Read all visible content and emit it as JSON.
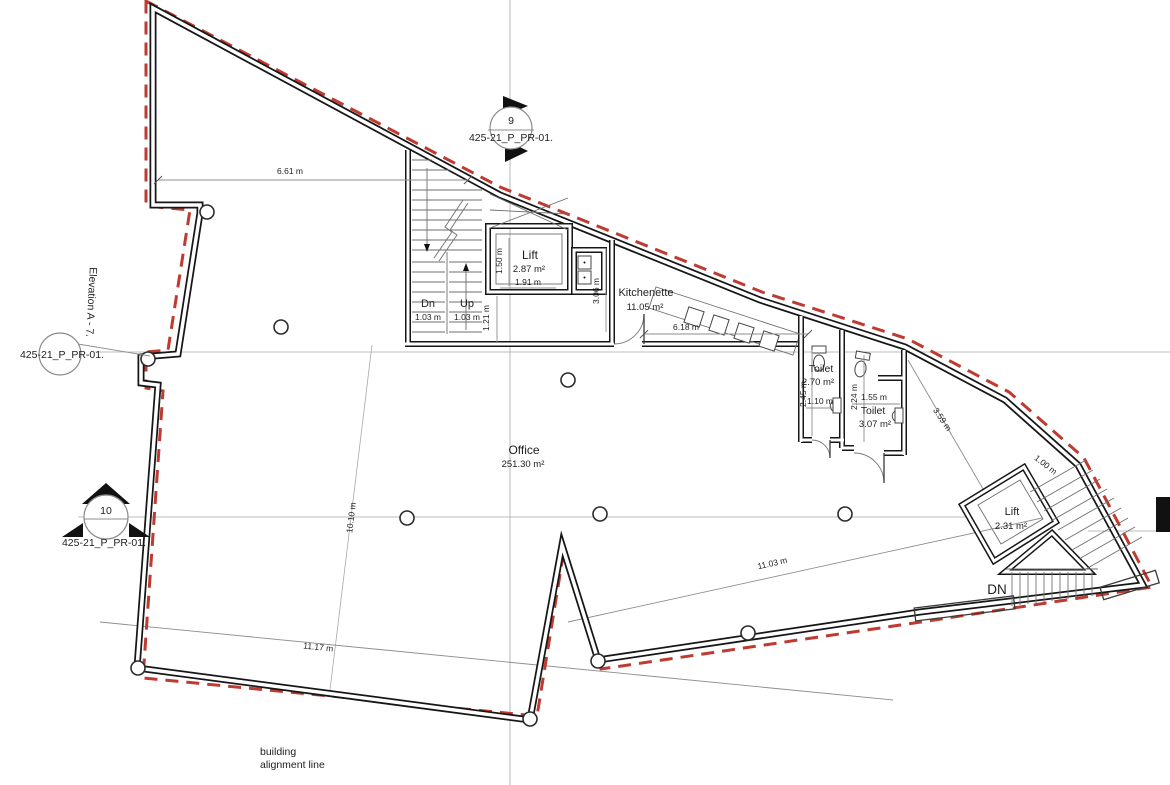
{
  "title": "floor plan",
  "colors": {
    "wall": "#161616",
    "alignment_line": "#bf3a30",
    "grid": "#a8a8a8",
    "text": "#1e1e1e"
  },
  "markers": {
    "section9": {
      "number": "9",
      "ref": "425-21_P_PR-01."
    },
    "elevation": {
      "label": "Elevation A - 7.",
      "ref": "425-21_P_PR-01."
    },
    "section10": {
      "number": "10",
      "ref": "425-21_P_PR-01."
    }
  },
  "rooms": {
    "office": {
      "name": "Office",
      "area": "251.30 m²"
    },
    "lift_main": {
      "name": "Lift",
      "area": "2.87 m²"
    },
    "kitchenette": {
      "name": "Kitchenette",
      "area": "11.05 m²"
    },
    "toilet1": {
      "name": "Toilet",
      "area": "2.70 m²"
    },
    "toilet2": {
      "name": "Toilet",
      "area": "3.07 m²"
    },
    "lift_right": {
      "name": "Lift",
      "area": "2.31 m²"
    }
  },
  "stairs": {
    "down_label": "Dn",
    "down_width": "1.03 m",
    "up_label": "Up",
    "up_width": "1.03 m",
    "down_right_label": "DN"
  },
  "dimensions": {
    "top_left_edge": "6.61 m",
    "lift_depth": "1.50 m",
    "lift_width": "1.91 m",
    "landing": "1.21 m",
    "shaft": "3.06 m",
    "kitchenette_length": "6.18 m",
    "toilet1_depth": "2.45 m",
    "toilet1_width": "1.10 m",
    "toilet2_depth": "2.24 m",
    "toilet2_width": "1.55 m",
    "diag_to_lift": "3.59 m",
    "stair_flight": "1.00 m",
    "office_depth": "10.10 m",
    "bottom_right_edge": "11.03 m",
    "bottom_left_edge": "11.17 m"
  },
  "notes": {
    "line1": "building",
    "line2": "alignment line"
  }
}
